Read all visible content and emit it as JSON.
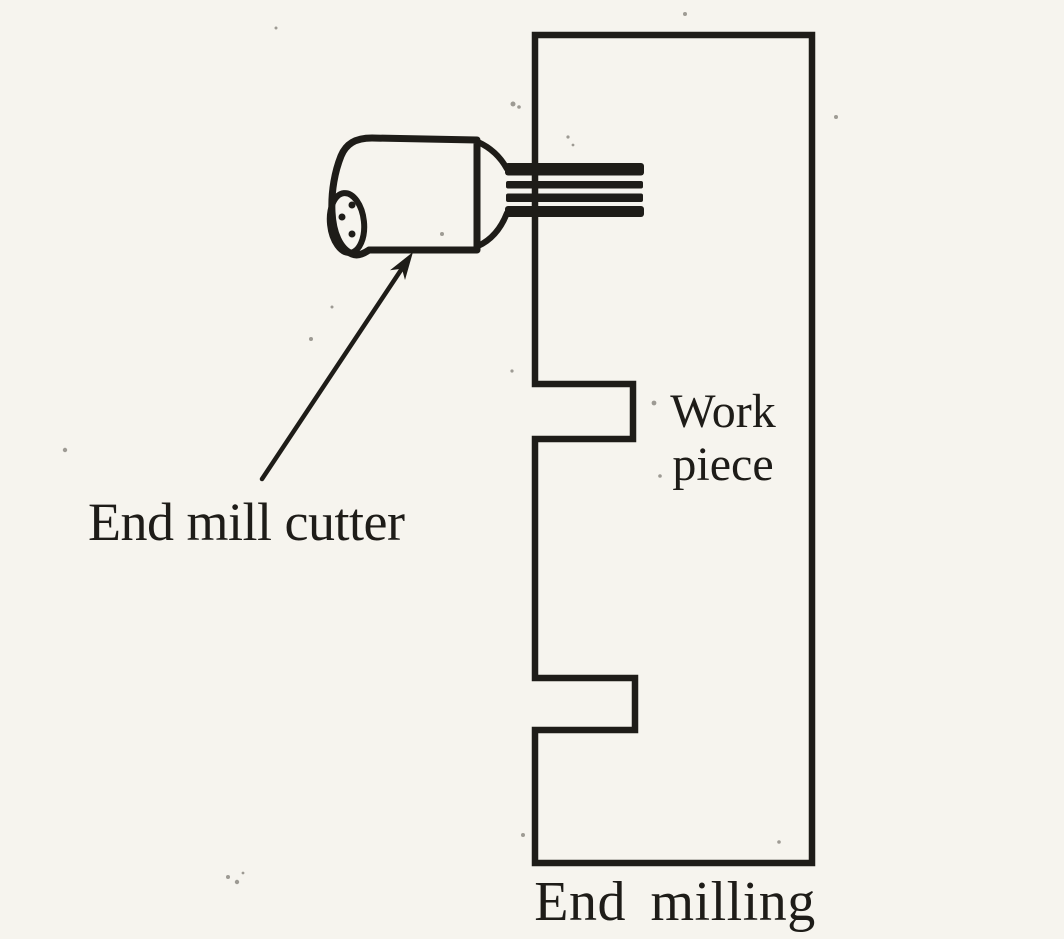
{
  "figure": {
    "subject": "end-milling-operation-diagram",
    "caption": "End milling"
  },
  "labels": {
    "cutter": "End mill cutter",
    "workpiece_line1": "Work",
    "workpiece_line2": "piece",
    "caption": "End milling"
  },
  "colors": {
    "background": "#f6f4ee",
    "ink": "#1e1c18",
    "speckle": "#55524a"
  }
}
